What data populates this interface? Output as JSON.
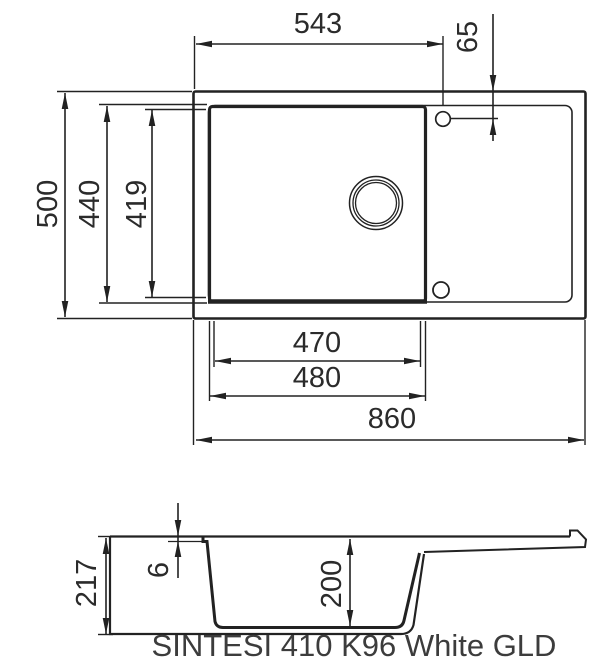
{
  "drawing": {
    "caption": "SINTESI 410 K96 White GLD",
    "colors": {
      "line": "#222222",
      "dim_text": "#2b2b2b",
      "caption_text": "#3c3c3c",
      "background": "#ffffff"
    }
  },
  "dimensions": {
    "left_edge_to_tap_hole": "543",
    "tap_hole_offset_from_edge": "65",
    "overall_depth": "500",
    "bowl_outer_depth": "440",
    "bowl_inner_depth": "419",
    "bowl_inner_width": "470",
    "bowl_outer_width": "480",
    "overall_width": "860",
    "overall_height": "217",
    "rim_thickness": "6",
    "bowl_depth": "200"
  }
}
